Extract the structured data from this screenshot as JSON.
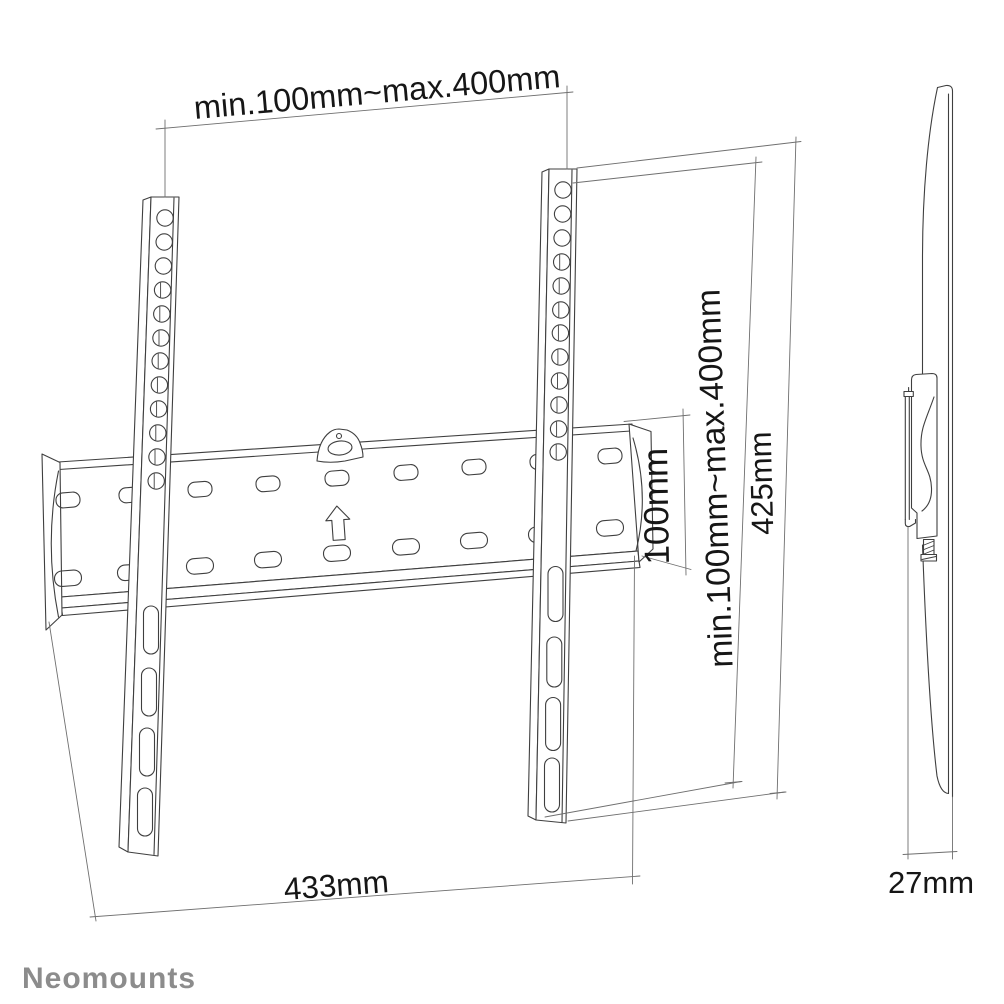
{
  "page": {
    "background": "#ffffff"
  },
  "brand": {
    "logo_text": "Neomounts",
    "logo_color": "#8c8c8c"
  },
  "diagram": {
    "line_color": "#3f3f3f",
    "dimension_line_color": "#6f6f6f",
    "text_color": "#161616",
    "labels": {
      "vesa_width": "min.100mm~max.400mm",
      "vesa_height": "min.100mm~max.400mm",
      "plate_height": "100mm",
      "rail_height": "425mm",
      "plate_width": "433mm",
      "wall_distance": "27mm"
    }
  }
}
